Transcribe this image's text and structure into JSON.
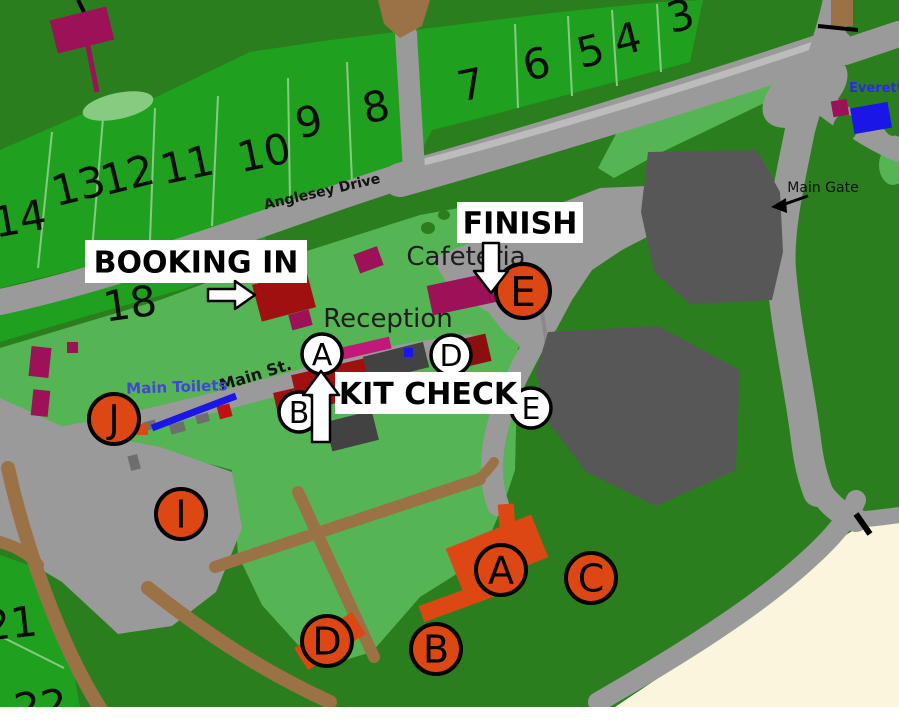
{
  "map": {
    "colors": {
      "dark_green": "#2b7e1d",
      "field_green": "#1fa01f",
      "light_green": "#55b554",
      "pale_green": "#86cb80",
      "road_gray": "#9a9a9a",
      "road_light": "#bcbcbc",
      "parking_gray": "#575757",
      "building_dark_gray": "#424242",
      "bin_gray": "#6e6e6e",
      "brown": "#9b7146",
      "magenta": "#9c1157",
      "pink": "#c2187a",
      "dark_red": "#a01010",
      "deep_red": "#8c0f0f",
      "orange": "#dd4713",
      "blue": "#1a16e8",
      "blue_text": "#4444d8",
      "sand": "#faf5dc",
      "marker_outline": "#000000",
      "label_ink": "#161616"
    },
    "field_numbers": [
      {
        "n": "3",
        "x": 684,
        "y": 30,
        "rot": -14
      },
      {
        "n": "4",
        "x": 631,
        "y": 53,
        "rot": -14
      },
      {
        "n": "5",
        "x": 594,
        "y": 65,
        "rot": -14
      },
      {
        "n": "6",
        "x": 540,
        "y": 78,
        "rot": -14
      },
      {
        "n": "7",
        "x": 474,
        "y": 99,
        "rot": -12
      },
      {
        "n": "8",
        "x": 379,
        "y": 121,
        "rot": -12
      },
      {
        "n": "9",
        "x": 312,
        "y": 136,
        "rot": -12
      },
      {
        "n": "10",
        "x": 267,
        "y": 167,
        "rot": -12
      },
      {
        "n": "11",
        "x": 190,
        "y": 179,
        "rot": -12
      },
      {
        "n": "12",
        "x": 131,
        "y": 189,
        "rot": -14
      },
      {
        "n": "13",
        "x": 82,
        "y": 200,
        "rot": -14
      },
      {
        "n": "14",
        "x": 22,
        "y": 233,
        "rot": -10
      },
      {
        "n": "18",
        "x": 132,
        "y": 318,
        "rot": -8
      },
      {
        "n": "21",
        "x": 12,
        "y": 638,
        "rot": -6
      },
      {
        "n": "22",
        "x": 42,
        "y": 721,
        "rot": -6
      }
    ],
    "labels": [
      {
        "id": "cafeteria",
        "text": "Cafeteria",
        "x": 466,
        "y": 265,
        "size": 26,
        "rot": 0,
        "weight": "normal",
        "color": "#1d1d1d"
      },
      {
        "id": "reception",
        "text": "Reception",
        "x": 388,
        "y": 327,
        "size": 26,
        "rot": 0,
        "weight": "normal",
        "color": "#1d1d1d"
      },
      {
        "id": "anglesey-drive",
        "text": "Anglesey Drive",
        "x": 323,
        "y": 196,
        "size": 14,
        "rot": -13,
        "weight": "bold",
        "color": "#111111"
      },
      {
        "id": "main-st",
        "text": "Main St.",
        "x": 257,
        "y": 380,
        "size": 16,
        "rot": -17,
        "weight": "bold",
        "color": "#111111"
      },
      {
        "id": "main-toilets",
        "text": "Main Toilets",
        "x": 177,
        "y": 392,
        "size": 15,
        "rot": -2,
        "weight": "bold",
        "color": "#4444d8"
      },
      {
        "id": "main-gate",
        "text": "Main Gate",
        "x": 823,
        "y": 192,
        "size": 14,
        "rot": 0,
        "weight": "normal",
        "color": "#111111"
      },
      {
        "id": "everett",
        "text": "Everett",
        "x": 876,
        "y": 92,
        "size": 13,
        "rot": 0,
        "weight": "bold",
        "color": "#2a2ae6"
      }
    ],
    "overlays": [
      {
        "id": "booking-in",
        "text": "BOOKING IN",
        "box": [
          85,
          240,
          222,
          43
        ]
      },
      {
        "id": "finish",
        "text": "FINISH",
        "box": [
          457,
          202,
          126,
          41
        ]
      },
      {
        "id": "kit-check",
        "text": "KIT CHECK",
        "box": [
          335,
          372,
          186,
          42
        ]
      }
    ],
    "markers": [
      {
        "letter": "E",
        "x": 523,
        "y": 291,
        "r": 27,
        "style": "orange"
      },
      {
        "letter": "J",
        "x": 114,
        "y": 419,
        "r": 25,
        "style": "orange"
      },
      {
        "letter": "I",
        "x": 181,
        "y": 514,
        "r": 25,
        "style": "orange"
      },
      {
        "letter": "A",
        "x": 501,
        "y": 570,
        "r": 25,
        "style": "orange"
      },
      {
        "letter": "B",
        "x": 436,
        "y": 649,
        "r": 25,
        "style": "orange"
      },
      {
        "letter": "C",
        "x": 591,
        "y": 578,
        "r": 25,
        "style": "orange"
      },
      {
        "letter": "D",
        "x": 327,
        "y": 641,
        "r": 25,
        "style": "orange"
      },
      {
        "letter": "A",
        "x": 322,
        "y": 354,
        "r": 20,
        "style": "white"
      },
      {
        "letter": "B",
        "x": 299,
        "y": 412,
        "r": 20,
        "style": "white"
      },
      {
        "letter": "D",
        "x": 451,
        "y": 355,
        "r": 20,
        "style": "white"
      },
      {
        "letter": "E",
        "x": 531,
        "y": 408,
        "r": 20,
        "style": "white"
      }
    ]
  }
}
